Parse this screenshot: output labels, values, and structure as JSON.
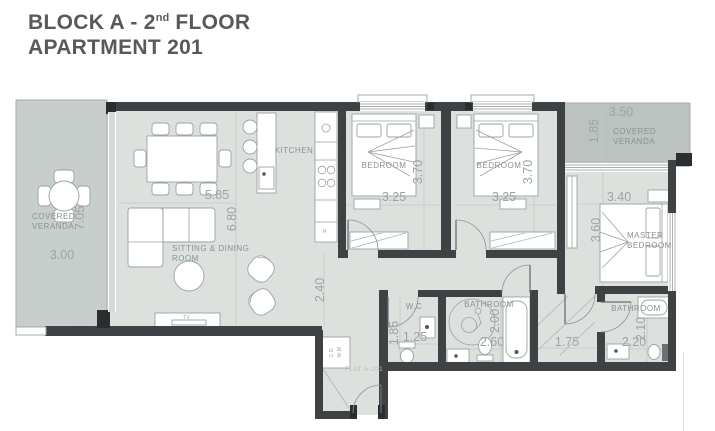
{
  "title": {
    "line1_prefix": "BLOCK A - 2",
    "line1_sup": "nd",
    "line1_suffix": " FLOOR",
    "line2": "APARTMENT 201"
  },
  "colors": {
    "title_text": "#58595b",
    "wall": "#3f4244",
    "room_fill": "#dce1de",
    "veranda_left_fill": "#c8cecb",
    "veranda_right_fill": "#bcc2bf",
    "dimension_text": "#9ca3a0",
    "room_label_text": "#8a928f",
    "furniture_stroke": "#9aa3a0"
  },
  "rooms": {
    "veranda_left": {
      "label_line1": "COVERED",
      "label_line2": "VERANDA",
      "width_dim": "3.00",
      "height_dim": "7.05"
    },
    "sitting_dining": {
      "label_line1": "SITTING & DINING",
      "label_line2": "ROOM",
      "width_dim": "5.85",
      "height_dim": "6.80",
      "hall_dim": "2.40"
    },
    "kitchen": {
      "label": "KITCHEN",
      "fridge_label": "R"
    },
    "living": {
      "tv_label": "TV"
    },
    "bedroom_1": {
      "label": "BEDROOM",
      "width_dim": "3.25",
      "height_dim": "3.70"
    },
    "bedroom_2": {
      "label": "BEDROOM",
      "width_dim": "3.25",
      "height_dim": "3.70"
    },
    "veranda_right": {
      "label_line1": "COVERED",
      "label_line2": "VERANDA",
      "width_dim": "3.50",
      "height_dim": "1.85"
    },
    "master_bedroom": {
      "label_line1": "MASTER",
      "label_line2": "BEDROOM",
      "width_dim": "3.40",
      "height_dim": "3.60"
    },
    "wc": {
      "label": "W.C",
      "width_dim": "1.25",
      "height_dim": "1.85"
    },
    "bathroom_main": {
      "label": "BATHROOM",
      "width_dim": "2.60",
      "height_dim": "2.00"
    },
    "corridor": {
      "width_dim": "1.75"
    },
    "bathroom_ensuite": {
      "label": "BATHROOM",
      "width_dim": "2.20",
      "height_dim": "2.10"
    },
    "entrance": {
      "flat_label": "FLAT A-201",
      "closet_label_line1": "C.D.",
      "closet_label_line2": "W.M"
    }
  }
}
